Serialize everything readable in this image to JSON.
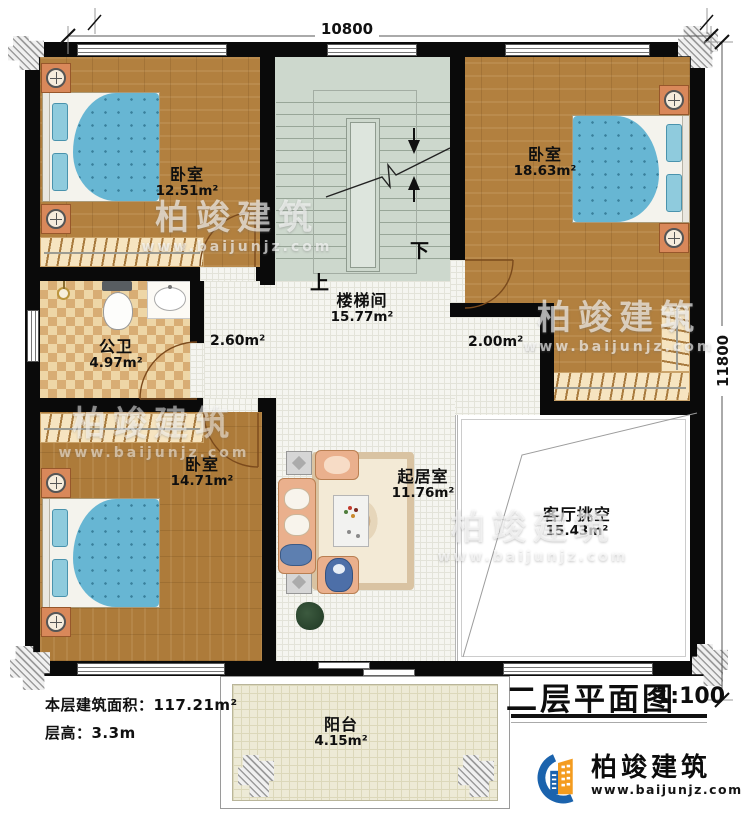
{
  "header": {
    "title": "二层平面图",
    "scale": "1:100"
  },
  "dimensions": {
    "width": "10800",
    "height": "11800"
  },
  "rooms": {
    "bedroom_tl": {
      "name": "卧室",
      "area": "12.51m²"
    },
    "bedroom_tr": {
      "name": "卧室",
      "area": "18.63m²"
    },
    "bedroom_bl": {
      "name": "卧室",
      "area": "14.71m²"
    },
    "stairwell": {
      "name": "楼梯间",
      "area": "15.77m²"
    },
    "bathroom": {
      "name": "公卫",
      "area": "4.97m²"
    },
    "living_room": {
      "name": "起居室",
      "area": "11.76m²"
    },
    "living_void": {
      "name": "客厅挑空",
      "area": "15.43m²"
    },
    "balcony": {
      "name": "阳台",
      "area": "4.15m²"
    },
    "hall_left_area": "2.60m²",
    "hall_right_area": "2.00m²"
  },
  "stairs": {
    "up": "上",
    "down": "下"
  },
  "notes": {
    "floor_area": "本层建筑面积：117.21m²",
    "floor_height": "层高：3.3m"
  },
  "logo": {
    "name": "柏竣建筑",
    "url": "www.baijunjz.com"
  },
  "watermark": {
    "name": "柏竣建筑",
    "url": "www.baijunjz.com"
  },
  "colors": {
    "wall": "#0a0a0a",
    "wood_floor": "#b2803f",
    "stair_floor": "#cdd8cd",
    "bath_tile": "#e7cc9c",
    "balcony_floor": "#edead6",
    "bed_quilt": "#67b6d3",
    "sofa": "#eab08d",
    "logo_blue": "#1b63ad",
    "logo_orange": "#f49c1f"
  }
}
